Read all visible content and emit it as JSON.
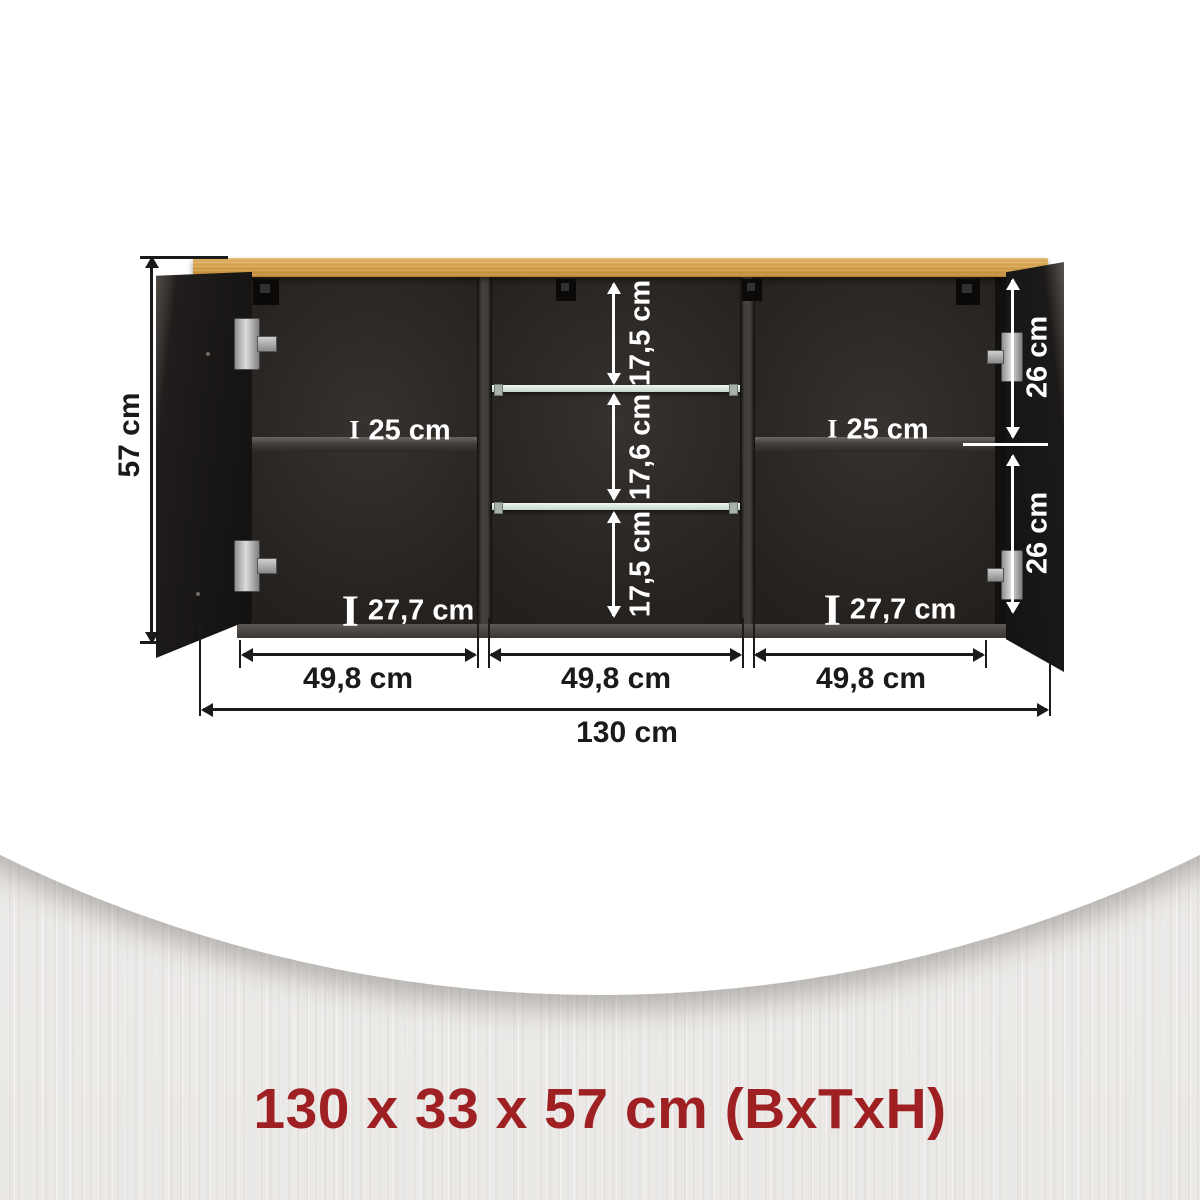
{
  "caption": "130 x 33 x 57 cm (BxTxH)",
  "labels": {
    "height": "57 cm",
    "total_width": "130 cm",
    "section_width_1": "49,8 cm",
    "section_width_2": "49,8 cm",
    "section_width_3": "49,8 cm",
    "gap_top": "17,5 cm",
    "gap_middle": "17,6 cm",
    "gap_bottom": "17,5 cm",
    "door_segment_top": "26 cm",
    "door_segment_bottom": "26 cm",
    "shelf_left": "25 cm",
    "shelf_right": "25 cm",
    "bottom_left": "27,7 cm",
    "bottom_right": "27,7 cm",
    "depth_marker": "I"
  },
  "colors": {
    "accent_red": "#9e2023",
    "oak_light": "#e0b264",
    "oak_dark": "#bd8635",
    "dimension_black": "#1a1a1a",
    "glass_green": "#d9e8dc",
    "label_white": "#ffffff"
  }
}
